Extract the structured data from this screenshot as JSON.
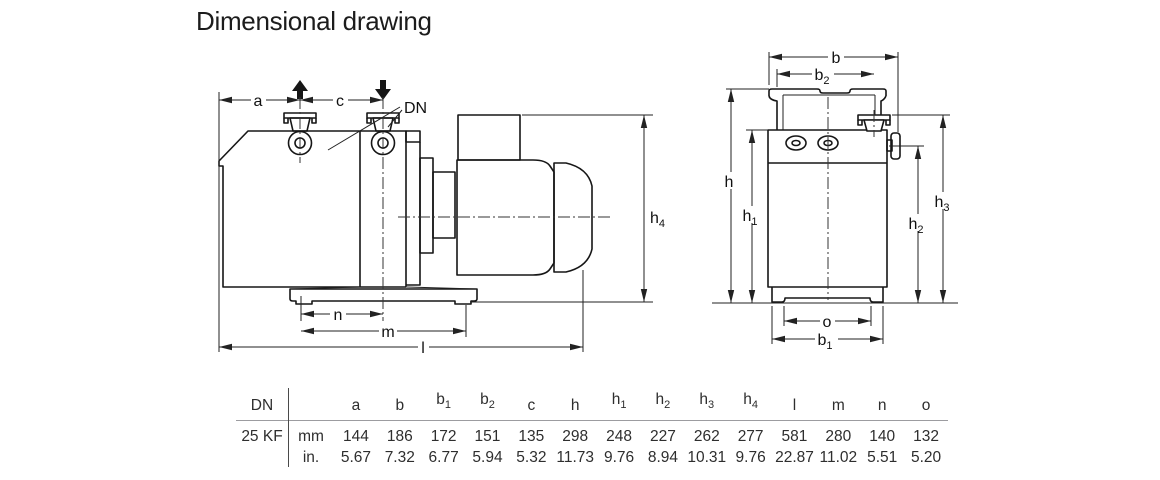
{
  "title": "Dimensional drawing",
  "drawing": {
    "labels": {
      "a": {
        "t": "a",
        "s": ""
      },
      "c": {
        "t": "c",
        "s": ""
      },
      "dn": {
        "t": "DN",
        "s": ""
      },
      "h4": {
        "t": "h",
        "s": "4"
      },
      "n": {
        "t": "n",
        "s": ""
      },
      "m": {
        "t": "m",
        "s": ""
      },
      "l": {
        "t": "l",
        "s": ""
      },
      "b": {
        "t": "b",
        "s": ""
      },
      "b2": {
        "t": "b",
        "s": "2"
      },
      "h": {
        "t": "h",
        "s": ""
      },
      "h1": {
        "t": "h",
        "s": "1"
      },
      "h2": {
        "t": "h",
        "s": "2"
      },
      "h3": {
        "t": "h",
        "s": "3"
      },
      "o": {
        "t": "o",
        "s": ""
      },
      "b1": {
        "t": "b",
        "s": "1"
      }
    }
  },
  "table": {
    "corner_label": "DN",
    "row_label": "25 KF",
    "columns": [
      {
        "t": "a",
        "s": ""
      },
      {
        "t": "b",
        "s": ""
      },
      {
        "t": "b",
        "s": "1"
      },
      {
        "t": "b",
        "s": "2"
      },
      {
        "t": "c",
        "s": ""
      },
      {
        "t": "h",
        "s": ""
      },
      {
        "t": "h",
        "s": "1"
      },
      {
        "t": "h",
        "s": "2"
      },
      {
        "t": "h",
        "s": "3"
      },
      {
        "t": "h",
        "s": "4"
      },
      {
        "t": "l",
        "s": ""
      },
      {
        "t": "m",
        "s": ""
      },
      {
        "t": "n",
        "s": ""
      },
      {
        "t": "o",
        "s": ""
      }
    ],
    "rows": [
      {
        "unit": "mm",
        "values": [
          "144",
          "186",
          "172",
          "151",
          "135",
          "298",
          "248",
          "227",
          "262",
          "277",
          "581",
          "280",
          "140",
          "132"
        ]
      },
      {
        "unit": "in.",
        "values": [
          "5.67",
          "7.32",
          "6.77",
          "5.94",
          "5.32",
          "11.73",
          "9.76",
          "8.94",
          "10.31",
          "9.76",
          "22.87",
          "11.02",
          "5.51",
          "5.20"
        ]
      }
    ]
  }
}
